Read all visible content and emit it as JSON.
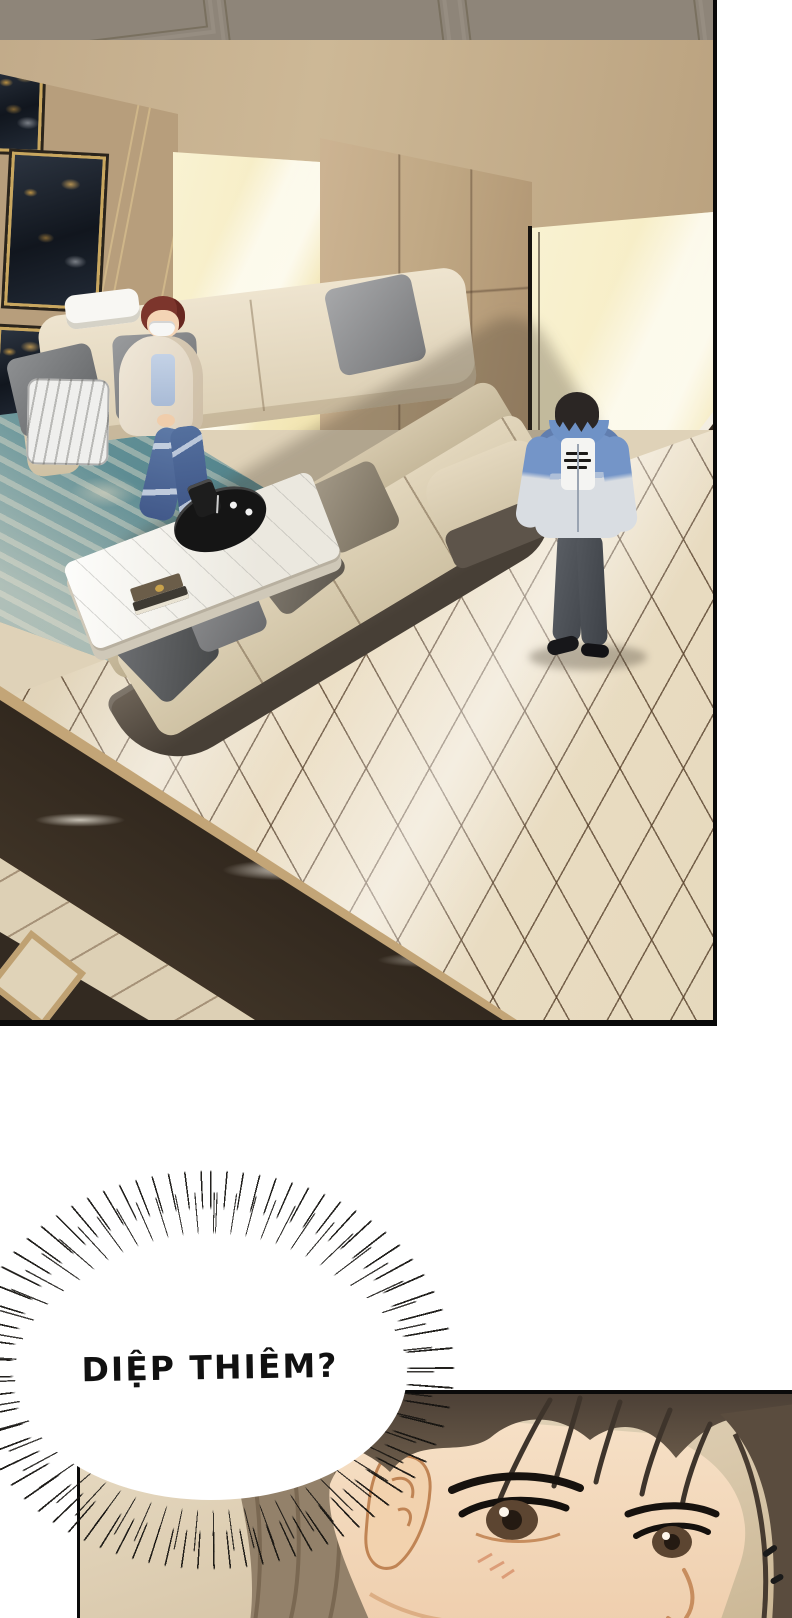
{
  "page": {
    "type": "comic-page",
    "background": "#ffffff"
  },
  "speech": {
    "burst_text": "DIỆP THIÊM?",
    "text_color": "#111111",
    "bubble_style": "scream-burst"
  },
  "panels": {
    "room": {
      "label": "living-room-scene",
      "border_color": "#090909",
      "colors": {
        "wall_gray": "#8e8579",
        "beam_marble": "#a98f72",
        "window_glow": "#f7efca",
        "wall_tan": "#c2ab8a",
        "floor_tile": "#e7dcc3",
        "dark_marble": "#332a20",
        "marble_trim": "#c3a577",
        "rug_teal": "#55868e",
        "sofa_cream": "#e8decb",
        "sofa_base_brown": "#55493d",
        "table_marble": "#f7f5ef",
        "tray_black": "#151515",
        "artwork_navy": "#1b2430",
        "artwork_gold": "#c9a24b"
      }
    },
    "closeup": {
      "label": "man-face-closeup",
      "border_color": "#0a0a0a",
      "colors": {
        "background_beige": "#d9c8ab",
        "hair_brown": "#5a4c3e",
        "skin": "#f2d7ba",
        "eye_brown": "#5c4531"
      },
      "marks": "two small dash marks lower right"
    }
  },
  "characters": {
    "sitting": {
      "label": "masked-man-sitting-on-sofa",
      "hair": "#7c352c",
      "mask": "#f7f7f5",
      "hoodie": "#ece4d4",
      "shirt": "#b9c9e2",
      "jeans": "#5a76a4"
    },
    "standing": {
      "label": "man-standing-by-window",
      "hair": "#2b2624",
      "jacket_blue": "#7495c8",
      "jacket_gray": "#d9dde2",
      "tee": "#f4f4f2",
      "pants": "#53575d",
      "shoes": "#17171a"
    }
  }
}
